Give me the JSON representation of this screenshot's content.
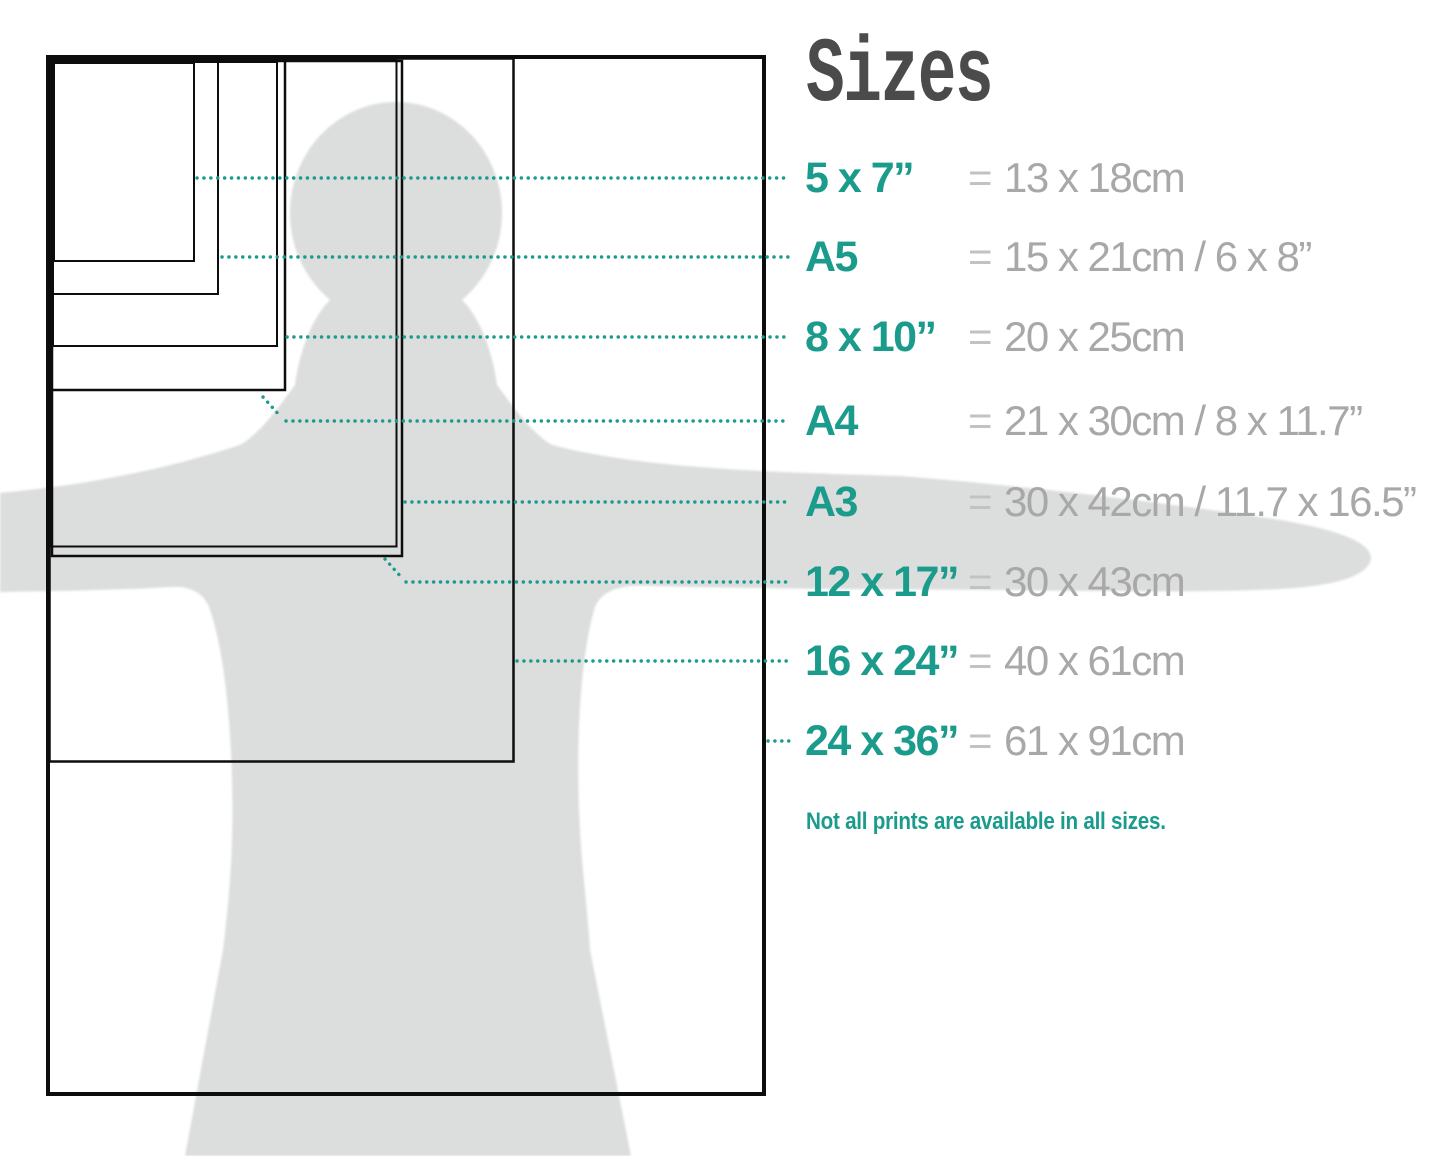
{
  "title": "Sizes",
  "rows": [
    {
      "label": "5 x 7”",
      "eq": "=",
      "value": "13 x 18cm"
    },
    {
      "label": "A5",
      "eq": "=",
      "value": "15 x 21cm / 6 x 8”"
    },
    {
      "label": "8 x 10”",
      "eq": "=",
      "value": "20 x 25cm"
    },
    {
      "label": "A4",
      "eq": "=",
      "value": "21 x 30cm / 8 x 11.7”"
    },
    {
      "label": "A3",
      "eq": "=",
      "value": "30 x 42cm / 11.7 x 16.5”"
    },
    {
      "label": "12 x 17”",
      "eq": "=",
      "value": "30 x 43cm"
    },
    {
      "label": "16 x 24”",
      "eq": "=",
      "value": "40 x 61cm"
    },
    {
      "label": "24 x 36”",
      "eq": "=",
      "value": "61 x 91cm"
    }
  ],
  "note": "Not all prints are available in all sizes.",
  "colors": {
    "accent_teal": "#1b9b8c",
    "value_gray": "#a8a8a8",
    "equals_gray": "#c2c2c2",
    "title_gray": "#4b4b4b",
    "silhouette_gray": "#dcdddd",
    "rectangle_black": "#0d0d0d"
  }
}
